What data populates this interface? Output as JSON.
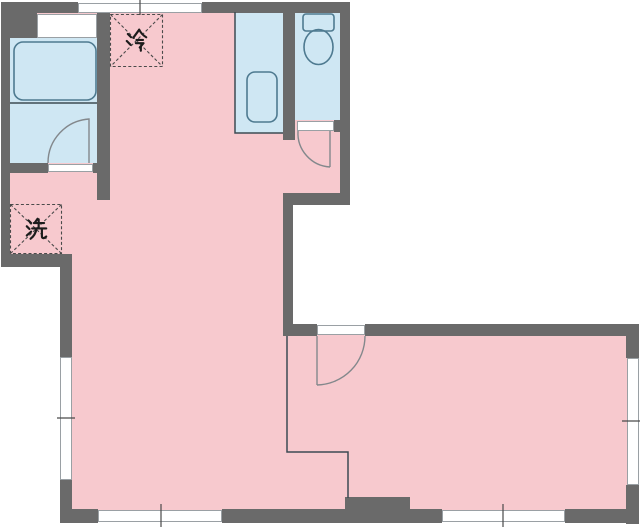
{
  "labels": {
    "refrigerator": "冷",
    "washer": "洗"
  },
  "colors": {
    "wall": "#6a6a6a",
    "pink": "#f7c9ce",
    "blue": "#cfe7f3",
    "winline": "#9aa0a4",
    "fixture": "#4e7a90",
    "thin": "#3d4b53",
    "door": "#83888c",
    "dash": "#4a4a4a",
    "ink": "#1c1c1c"
  }
}
